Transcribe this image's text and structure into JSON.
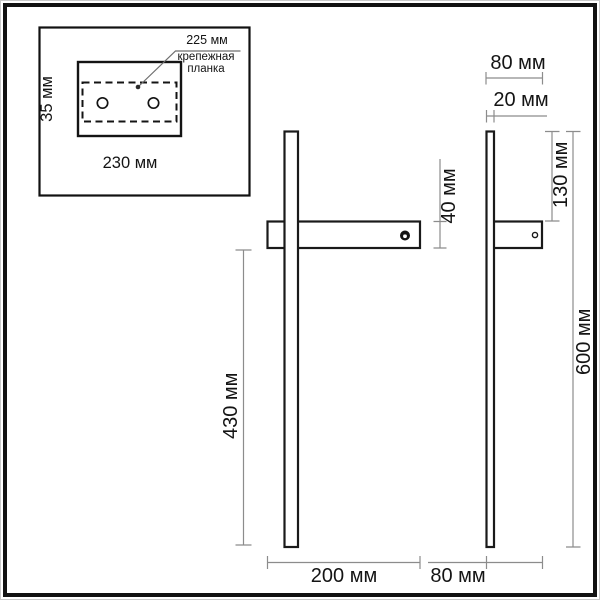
{
  "colors": {
    "outline": "#141414",
    "dimension_lines": "#8c8c8c",
    "background": "#ffffff"
  },
  "inset": {
    "strip_width_label": "225 мм",
    "strip_caption_line1": "крепежная",
    "strip_caption_line2": "планка",
    "plate_height_label": "35 мм",
    "plate_width_label": "230 мм"
  },
  "front_view": {
    "bracket_height_label": "40 мм",
    "rod_length_label": "430 мм",
    "bracket_width_label": "200 мм"
  },
  "side_view": {
    "top_depth_label": "80 мм",
    "rod_depth_label": "20 мм",
    "upper_rod_label": "130 мм",
    "total_height_label": "600 мм",
    "bottom_depth_label": "80 мм"
  }
}
